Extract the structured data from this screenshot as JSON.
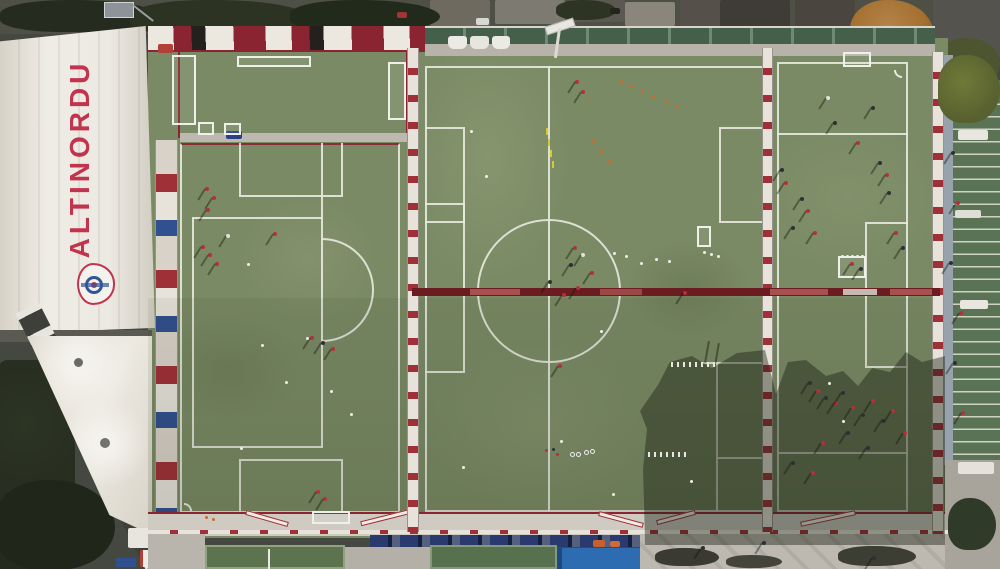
{
  "scene": {
    "description": "Aerial drone view of the Altinordu football club training facility: three artificial pitches with training sessions in progress, white stand roof with club name, tent canopy, tribune and service areas."
  },
  "branding": {
    "roof_text": "ALTINORDU",
    "crest": "altinordu-club-crest"
  },
  "palette": {
    "css": {
      "turf": "#7a8a64",
      "turf_dark": "#6d7d58",
      "line": "#e8eadf",
      "fence_red": "#a03038",
      "pitch_red": "#8a2430",
      "barrier": "#6b1c21",
      "brand_red": "#c2334d",
      "roof": "#ece9e2",
      "pave": "#c6c2ba",
      "seat_blue": "#2b3a6e",
      "canopy_blue": "#2e6cb2",
      "tree_dark": "#252a1e",
      "autumn": "#a3702f",
      "stand_green": "#5a7355",
      "ball": "#eef0e6"
    },
    "marker_colors": {
      "r": "#b5303a",
      "w": "#e4e4dc",
      "d": "#2e3038",
      "o": "#d06828",
      "b": "#3555a0",
      "y": "#d9c832"
    }
  },
  "markers": {
    "players": [
      {
        "x": 205,
        "y": 187,
        "c": "r"
      },
      {
        "x": 212,
        "y": 196,
        "c": "r"
      },
      {
        "x": 206,
        "y": 208,
        "c": "r"
      },
      {
        "x": 201,
        "y": 245,
        "c": "r"
      },
      {
        "x": 208,
        "y": 253,
        "c": "r"
      },
      {
        "x": 215,
        "y": 262,
        "c": "r"
      },
      {
        "x": 226,
        "y": 234,
        "c": "w"
      },
      {
        "x": 273,
        "y": 232,
        "c": "r"
      },
      {
        "x": 310,
        "y": 336,
        "c": "r"
      },
      {
        "x": 321,
        "y": 341,
        "c": "d"
      },
      {
        "x": 331,
        "y": 347,
        "c": "r"
      },
      {
        "x": 316,
        "y": 490,
        "c": "r"
      },
      {
        "x": 323,
        "y": 497,
        "c": "r"
      },
      {
        "x": 573,
        "y": 246,
        "c": "r"
      },
      {
        "x": 581,
        "y": 253,
        "c": "w"
      },
      {
        "x": 569,
        "y": 263,
        "c": "d"
      },
      {
        "x": 590,
        "y": 271,
        "c": "r"
      },
      {
        "x": 576,
        "y": 286,
        "c": "r"
      },
      {
        "x": 562,
        "y": 293,
        "c": "r"
      },
      {
        "x": 548,
        "y": 280,
        "c": "d"
      },
      {
        "x": 558,
        "y": 364,
        "c": "r"
      },
      {
        "x": 575,
        "y": 80,
        "c": "r"
      },
      {
        "x": 581,
        "y": 90,
        "c": "r"
      },
      {
        "x": 683,
        "y": 291,
        "c": "r"
      },
      {
        "x": 780,
        "y": 168,
        "c": "d"
      },
      {
        "x": 784,
        "y": 181,
        "c": "r"
      },
      {
        "x": 800,
        "y": 197,
        "c": "d"
      },
      {
        "x": 806,
        "y": 209,
        "c": "r"
      },
      {
        "x": 791,
        "y": 226,
        "c": "d"
      },
      {
        "x": 813,
        "y": 231,
        "c": "r"
      },
      {
        "x": 878,
        "y": 161,
        "c": "d"
      },
      {
        "x": 885,
        "y": 173,
        "c": "r"
      },
      {
        "x": 887,
        "y": 191,
        "c": "d"
      },
      {
        "x": 894,
        "y": 231,
        "c": "r"
      },
      {
        "x": 901,
        "y": 246,
        "c": "d"
      },
      {
        "x": 856,
        "y": 141,
        "c": "r"
      },
      {
        "x": 833,
        "y": 121,
        "c": "d"
      },
      {
        "x": 826,
        "y": 96,
        "c": "w"
      },
      {
        "x": 871,
        "y": 106,
        "c": "d"
      },
      {
        "x": 850,
        "y": 262,
        "c": "r"
      },
      {
        "x": 859,
        "y": 267,
        "c": "d"
      },
      {
        "x": 808,
        "y": 381,
        "c": "d"
      },
      {
        "x": 816,
        "y": 389,
        "c": "r"
      },
      {
        "x": 824,
        "y": 396,
        "c": "d"
      },
      {
        "x": 834,
        "y": 401,
        "c": "r"
      },
      {
        "x": 841,
        "y": 391,
        "c": "d"
      },
      {
        "x": 851,
        "y": 406,
        "c": "r"
      },
      {
        "x": 861,
        "y": 413,
        "c": "d"
      },
      {
        "x": 871,
        "y": 399,
        "c": "r"
      },
      {
        "x": 881,
        "y": 419,
        "c": "d"
      },
      {
        "x": 891,
        "y": 409,
        "c": "r"
      },
      {
        "x": 846,
        "y": 431,
        "c": "d"
      },
      {
        "x": 821,
        "y": 441,
        "c": "r"
      },
      {
        "x": 866,
        "y": 446,
        "c": "d"
      },
      {
        "x": 903,
        "y": 431,
        "c": "r"
      },
      {
        "x": 791,
        "y": 461,
        "c": "d"
      },
      {
        "x": 811,
        "y": 471,
        "c": "r"
      },
      {
        "x": 951,
        "y": 151,
        "c": "d"
      },
      {
        "x": 956,
        "y": 201,
        "c": "r"
      },
      {
        "x": 949,
        "y": 261,
        "c": "d"
      },
      {
        "x": 959,
        "y": 311,
        "c": "r"
      },
      {
        "x": 953,
        "y": 361,
        "c": "d"
      },
      {
        "x": 961,
        "y": 411,
        "c": "r"
      },
      {
        "x": 701,
        "y": 546,
        "c": "d"
      },
      {
        "x": 762,
        "y": 541,
        "c": "d"
      },
      {
        "x": 872,
        "y": 556,
        "c": "d"
      }
    ],
    "cones": [
      {
        "x": 620,
        "y": 80,
        "c": "o"
      },
      {
        "x": 630,
        "y": 85,
        "c": "o"
      },
      {
        "x": 641,
        "y": 90,
        "c": "o"
      },
      {
        "x": 652,
        "y": 95,
        "c": "o"
      },
      {
        "x": 665,
        "y": 100,
        "c": "o"
      },
      {
        "x": 676,
        "y": 105,
        "c": "o"
      },
      {
        "x": 587,
        "y": 97,
        "c": "o"
      },
      {
        "x": 592,
        "y": 140,
        "c": "o"
      },
      {
        "x": 600,
        "y": 150,
        "c": "o"
      },
      {
        "x": 608,
        "y": 160,
        "c": "o"
      },
      {
        "x": 545,
        "y": 449,
        "c": "r"
      },
      {
        "x": 552,
        "y": 448,
        "c": "d"
      },
      {
        "x": 556,
        "y": 453,
        "c": "r"
      },
      {
        "x": 683,
        "y": 452,
        "c": "r"
      },
      {
        "x": 205,
        "y": 516,
        "c": "o"
      },
      {
        "x": 212,
        "y": 518,
        "c": "o"
      }
    ],
    "balls": [
      {
        "x": 247,
        "y": 263
      },
      {
        "x": 261,
        "y": 344
      },
      {
        "x": 285,
        "y": 381
      },
      {
        "x": 306,
        "y": 337
      },
      {
        "x": 350,
        "y": 413
      },
      {
        "x": 240,
        "y": 447
      },
      {
        "x": 330,
        "y": 390
      },
      {
        "x": 613,
        "y": 252
      },
      {
        "x": 625,
        "y": 255
      },
      {
        "x": 640,
        "y": 262
      },
      {
        "x": 655,
        "y": 258
      },
      {
        "x": 668,
        "y": 260
      },
      {
        "x": 703,
        "y": 251
      },
      {
        "x": 710,
        "y": 253
      },
      {
        "x": 717,
        "y": 255
      },
      {
        "x": 612,
        "y": 493
      },
      {
        "x": 600,
        "y": 330
      },
      {
        "x": 560,
        "y": 440
      },
      {
        "x": 690,
        "y": 480
      },
      {
        "x": 828,
        "y": 382
      },
      {
        "x": 842,
        "y": 420
      },
      {
        "x": 462,
        "y": 466
      },
      {
        "x": 841,
        "y": 255
      },
      {
        "x": 846,
        "y": 255
      },
      {
        "x": 851,
        "y": 255
      },
      {
        "x": 856,
        "y": 255
      },
      {
        "x": 861,
        "y": 255
      },
      {
        "x": 470,
        "y": 130
      },
      {
        "x": 485,
        "y": 175
      }
    ],
    "rings": [
      {
        "x": 570,
        "y": 452
      },
      {
        "x": 576,
        "y": 452
      },
      {
        "x": 584,
        "y": 450
      },
      {
        "x": 590,
        "y": 449
      }
    ],
    "sticks": [
      {
        "x": 546,
        "y": 128
      },
      {
        "x": 548,
        "y": 139
      },
      {
        "x": 550,
        "y": 150
      },
      {
        "x": 552,
        "y": 161
      }
    ],
    "hurdle_rows": [
      {
        "x": 671,
        "y": 362,
        "n": 8,
        "gap": 6
      },
      {
        "x": 648,
        "y": 452,
        "n": 7,
        "gap": 6
      }
    ],
    "pole_shadows": [
      {
        "x": 706,
        "y": 341
      },
      {
        "x": 716,
        "y": 343
      }
    ],
    "goals": [
      {
        "x": 198,
        "y": 122,
        "w": 16,
        "h": 13
      },
      {
        "x": 224,
        "y": 123,
        "w": 17,
        "h": 12
      },
      {
        "x": 237,
        "y": 56,
        "w": 74,
        "h": 11
      },
      {
        "x": 388,
        "y": 62,
        "w": 18,
        "h": 58
      },
      {
        "x": 172,
        "y": 55,
        "w": 24,
        "h": 70
      },
      {
        "x": 697,
        "y": 226,
        "w": 14,
        "h": 21
      },
      {
        "x": 838,
        "y": 256,
        "w": 28,
        "h": 22
      },
      {
        "x": 843,
        "y": 52,
        "w": 28,
        "h": 15
      },
      {
        "x": 312,
        "y": 511,
        "w": 38,
        "h": 13
      }
    ]
  }
}
